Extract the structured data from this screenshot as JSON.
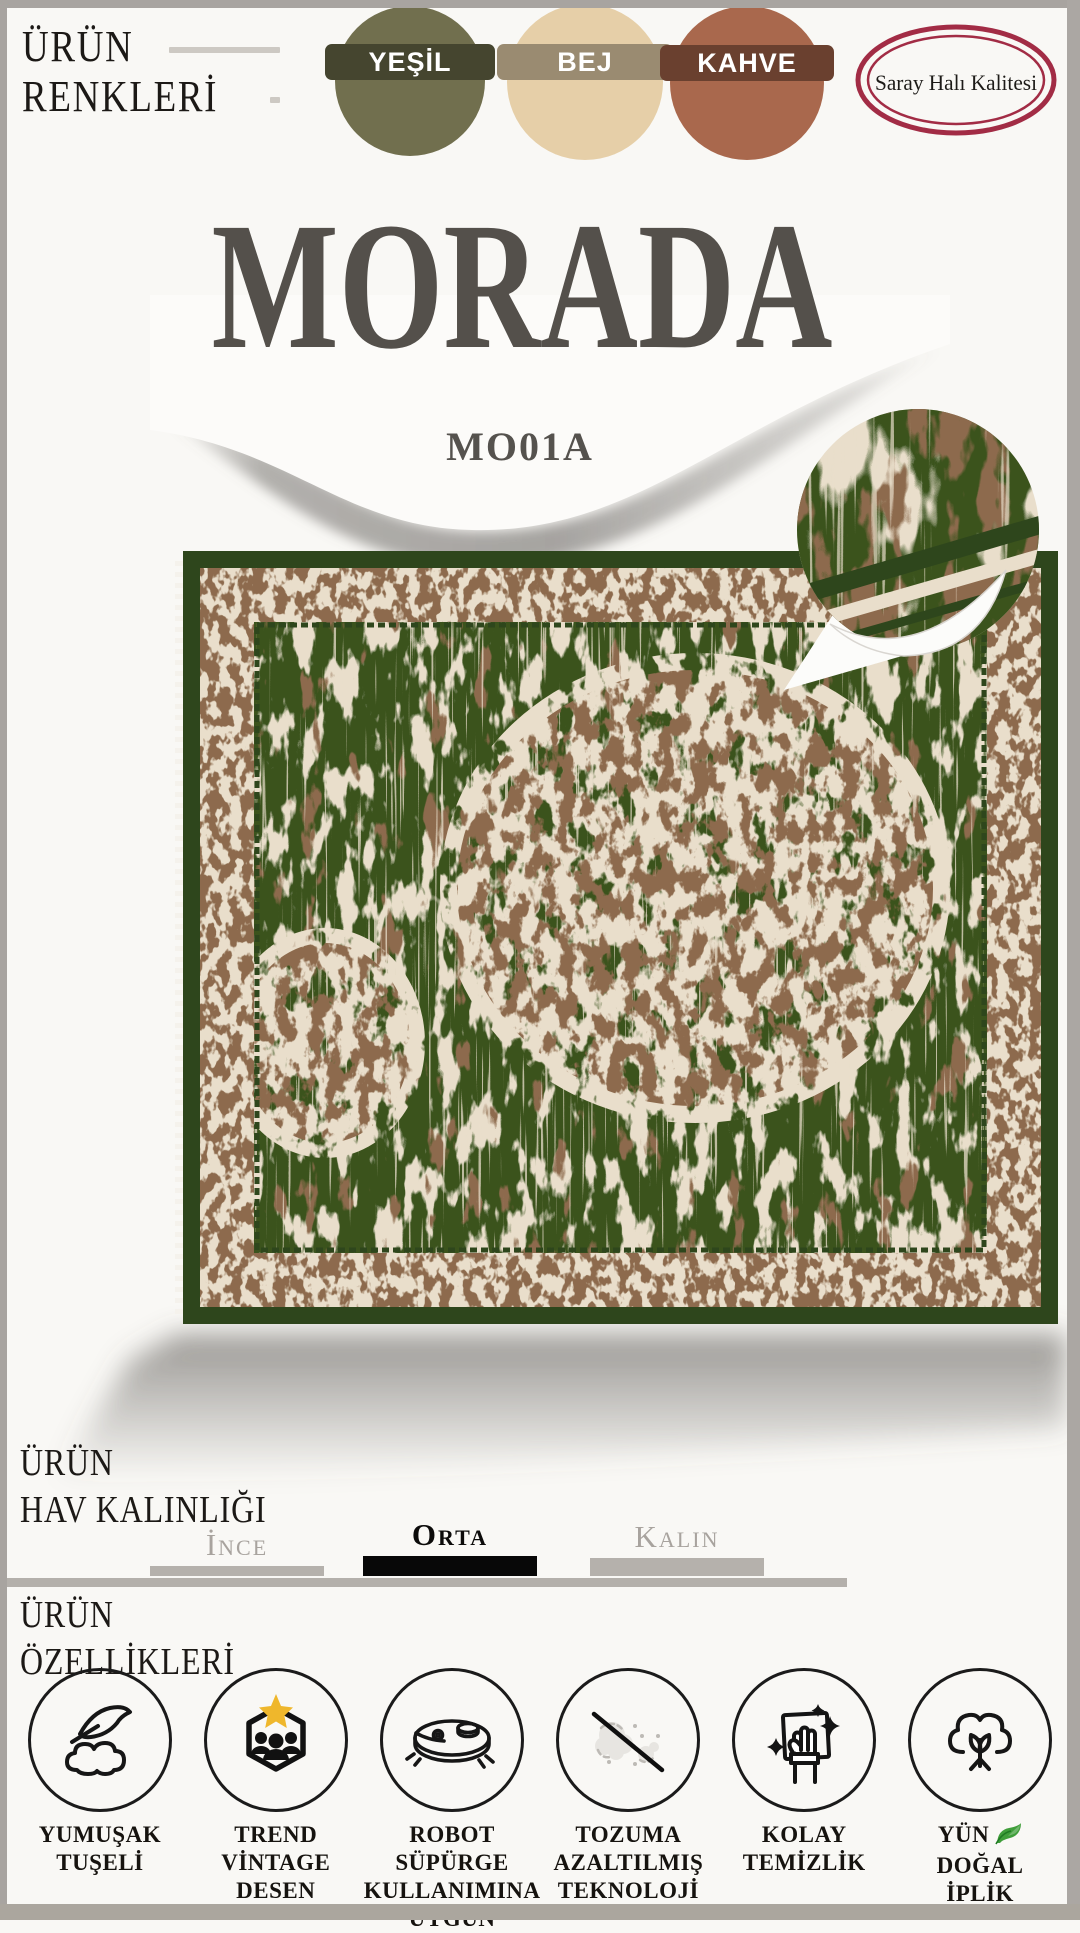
{
  "page": {
    "background": "#f9f8f5",
    "frame_color": "#a8a4a0"
  },
  "colors_section": {
    "heading_line1": "ÜRÜN",
    "heading_line2": "RENKLERİ",
    "swatches": [
      {
        "name": "YEŞİL",
        "circle_color": "#716f4e",
        "band_color": "#45452f"
      },
      {
        "name": "BEJ",
        "circle_color": "#e6cfa8",
        "band_color": "#9a8b71"
      },
      {
        "name": "KAHVE",
        "circle_color": "#a9684d",
        "band_color": "#6a402f"
      }
    ],
    "badge": {
      "text": "Saray Halı Kalitesi",
      "ring_color": "#a22c45",
      "text_color": "#1d1b18"
    }
  },
  "product": {
    "name": "MORADA",
    "code": "MO01A",
    "name_color": "#54504b"
  },
  "rug": {
    "palette": {
      "green": "#3a531f",
      "dark_green": "#2e461c",
      "cream": "#e9decb",
      "brown": "#8d6b4d"
    }
  },
  "pile_section": {
    "heading_line1": "ÜRÜN",
    "heading_line2": "HAV KALINLIĞI",
    "options": [
      {
        "label": "İnce",
        "selected": false
      },
      {
        "label": "Orta",
        "selected": true
      },
      {
        "label": "Kalın",
        "selected": false
      }
    ]
  },
  "features_section": {
    "heading_line1": "ÜRÜN",
    "heading_line2": "ÖZELLİKLERİ",
    "star_color": "#efb72c",
    "leaf_color": "#3f9e3a",
    "items": [
      {
        "icon": "soft-touch",
        "lines": [
          "YUMUŞAK",
          "TUŞELİ"
        ]
      },
      {
        "icon": "trend-vintage",
        "lines": [
          "TREND",
          "VİNTAGE",
          "DESEN"
        ]
      },
      {
        "icon": "robot-vacuum",
        "lines": [
          "ROBOT SÜPÜRGE",
          "KULLANIMINA",
          "UYGUN"
        ]
      },
      {
        "icon": "dust-reduced",
        "lines": [
          "TOZUMA",
          "AZALTILMIŞ",
          "TEKNOLOJİ"
        ]
      },
      {
        "icon": "easy-clean",
        "lines": [
          "KOLAY",
          "TEMİZLİK"
        ]
      },
      {
        "icon": "natural-wool",
        "lines": [
          "YÜN",
          "DOĞAL",
          "İPLİK"
        ]
      }
    ]
  }
}
